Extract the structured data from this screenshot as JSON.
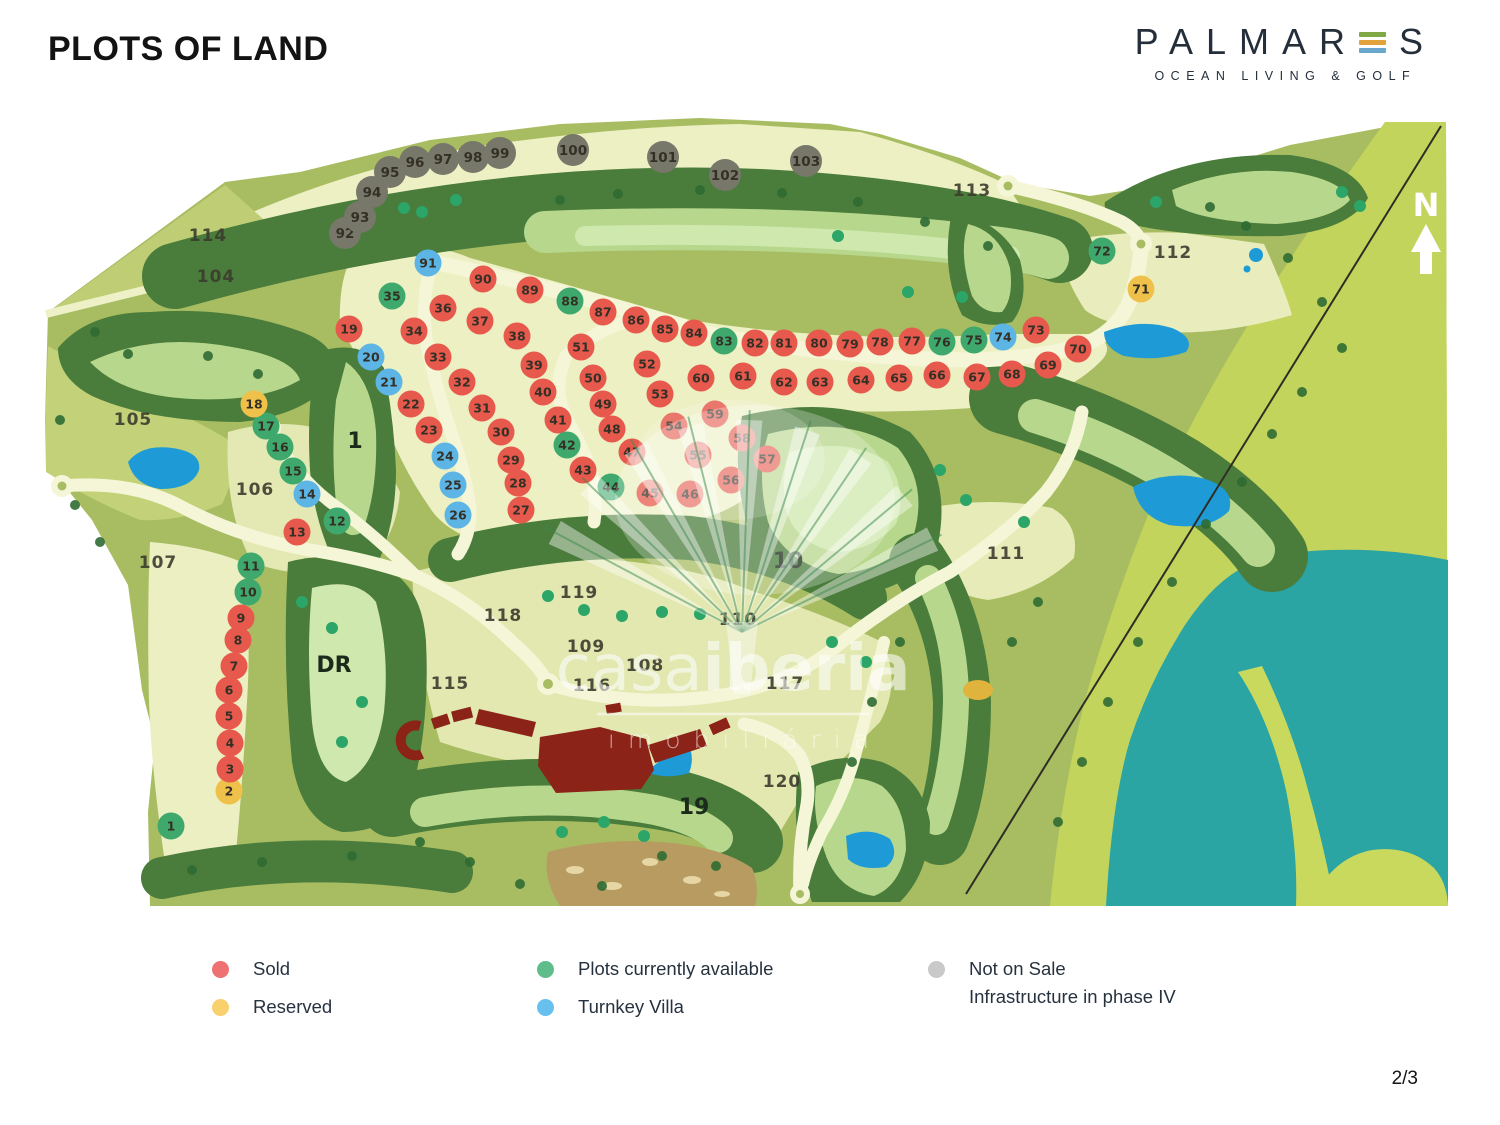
{
  "header": {
    "title": "PLOTS OF LAND"
  },
  "logo": {
    "brand_left": "PALMAR",
    "brand_right": "S",
    "subtitle": "OCEAN LIVING & GOLF",
    "bar_colors": [
      "#7fa944",
      "#e2a33c",
      "#69a7cd"
    ]
  },
  "page": {
    "number": "2/3"
  },
  "compass": {
    "label": "N"
  },
  "watermark": {
    "word1": "casa",
    "word2": "iberia",
    "line2": "imobiliária"
  },
  "legend": {
    "items": [
      {
        "label": "Sold",
        "color": "#ef7272"
      },
      {
        "label": "Reserved",
        "color": "#f8d06d"
      },
      {
        "label": "Plots currently available",
        "color": "#5fbd8b"
      },
      {
        "label": "Turnkey Villa",
        "color": "#67c0ee"
      },
      {
        "label": "Not on Sale",
        "label2": "Infrastructure in phase IV",
        "color": "#c9c9c9"
      }
    ]
  },
  "map": {
    "status_colors": {
      "sold": "#e6594c",
      "reserved": "#f0c14a",
      "available": "#3fa96d",
      "turnkey": "#5cb5e5",
      "notsale": "#77776a"
    },
    "plots": [
      [
        "1",
        171,
        826,
        "available"
      ],
      [
        "2",
        229,
        791,
        "reserved"
      ],
      [
        "3",
        230,
        769,
        "sold"
      ],
      [
        "4",
        230,
        743,
        "sold"
      ],
      [
        "5",
        229,
        716,
        "sold"
      ],
      [
        "6",
        229,
        690,
        "sold"
      ],
      [
        "7",
        234,
        666,
        "sold"
      ],
      [
        "8",
        238,
        640,
        "sold"
      ],
      [
        "9",
        241,
        618,
        "sold"
      ],
      [
        "10",
        248,
        592,
        "available"
      ],
      [
        "11",
        251,
        566,
        "available"
      ],
      [
        "12",
        337,
        521,
        "available"
      ],
      [
        "13",
        297,
        532,
        "sold"
      ],
      [
        "14",
        307,
        494,
        "turnkey"
      ],
      [
        "15",
        293,
        471,
        "available"
      ],
      [
        "16",
        280,
        447,
        "available"
      ],
      [
        "17",
        266,
        426,
        "available"
      ],
      [
        "18",
        254,
        404,
        "reserved"
      ],
      [
        "19",
        349,
        329,
        "sold"
      ],
      [
        "20",
        371,
        357,
        "turnkey"
      ],
      [
        "21",
        389,
        382,
        "turnkey"
      ],
      [
        "22",
        411,
        404,
        "sold"
      ],
      [
        "23",
        429,
        430,
        "sold"
      ],
      [
        "24",
        445,
        456,
        "turnkey"
      ],
      [
        "25",
        453,
        485,
        "turnkey"
      ],
      [
        "26",
        458,
        515,
        "turnkey"
      ],
      [
        "27",
        521,
        510,
        "sold"
      ],
      [
        "28",
        518,
        483,
        "sold"
      ],
      [
        "29",
        511,
        460,
        "sold"
      ],
      [
        "30",
        501,
        432,
        "sold"
      ],
      [
        "31",
        482,
        408,
        "sold"
      ],
      [
        "32",
        462,
        382,
        "sold"
      ],
      [
        "33",
        438,
        357,
        "sold"
      ],
      [
        "34",
        414,
        331,
        "sold"
      ],
      [
        "35",
        392,
        296,
        "available"
      ],
      [
        "36",
        443,
        308,
        "sold"
      ],
      [
        "37",
        480,
        321,
        "sold"
      ],
      [
        "38",
        517,
        336,
        "sold"
      ],
      [
        "39",
        534,
        365,
        "sold"
      ],
      [
        "40",
        543,
        392,
        "sold"
      ],
      [
        "41",
        558,
        420,
        "sold"
      ],
      [
        "42",
        567,
        445,
        "available"
      ],
      [
        "43",
        583,
        470,
        "sold"
      ],
      [
        "44",
        611,
        487,
        "available"
      ],
      [
        "45",
        650,
        493,
        "sold"
      ],
      [
        "46",
        690,
        494,
        "sold"
      ],
      [
        "47",
        632,
        452,
        "sold"
      ],
      [
        "48",
        612,
        429,
        "sold"
      ],
      [
        "49",
        603,
        404,
        "sold"
      ],
      [
        "50",
        593,
        378,
        "sold"
      ],
      [
        "51",
        581,
        347,
        "sold"
      ],
      [
        "52",
        647,
        364,
        "sold"
      ],
      [
        "53",
        660,
        394,
        "sold"
      ],
      [
        "54",
        674,
        426,
        "sold"
      ],
      [
        "55",
        698,
        455,
        "sold"
      ],
      [
        "56",
        731,
        480,
        "sold"
      ],
      [
        "57",
        767,
        459,
        "sold"
      ],
      [
        "58",
        742,
        438,
        "sold"
      ],
      [
        "59",
        715,
        414,
        "sold"
      ],
      [
        "60",
        701,
        378,
        "sold"
      ],
      [
        "61",
        743,
        376,
        "sold"
      ],
      [
        "62",
        784,
        382,
        "sold"
      ],
      [
        "63",
        820,
        382,
        "sold"
      ],
      [
        "64",
        861,
        380,
        "sold"
      ],
      [
        "65",
        899,
        378,
        "sold"
      ],
      [
        "66",
        937,
        375,
        "sold"
      ],
      [
        "67",
        977,
        377,
        "sold"
      ],
      [
        "68",
        1012,
        374,
        "sold"
      ],
      [
        "69",
        1048,
        365,
        "sold"
      ],
      [
        "70",
        1078,
        349,
        "sold"
      ],
      [
        "71",
        1141,
        289,
        "reserved"
      ],
      [
        "72",
        1102,
        251,
        "available"
      ],
      [
        "73",
        1036,
        330,
        "sold"
      ],
      [
        "74",
        1003,
        337,
        "turnkey"
      ],
      [
        "75",
        974,
        340,
        "available"
      ],
      [
        "76",
        942,
        342,
        "available"
      ],
      [
        "77",
        912,
        341,
        "sold"
      ],
      [
        "78",
        880,
        342,
        "sold"
      ],
      [
        "79",
        850,
        344,
        "sold"
      ],
      [
        "80",
        819,
        343,
        "sold"
      ],
      [
        "81",
        784,
        343,
        "sold"
      ],
      [
        "82",
        755,
        343,
        "sold"
      ],
      [
        "83",
        724,
        341,
        "available"
      ],
      [
        "84",
        694,
        333,
        "sold"
      ],
      [
        "85",
        665,
        329,
        "sold"
      ],
      [
        "86",
        636,
        320,
        "sold"
      ],
      [
        "87",
        603,
        312,
        "sold"
      ],
      [
        "88",
        570,
        301,
        "available"
      ],
      [
        "89",
        530,
        290,
        "sold"
      ],
      [
        "90",
        483,
        279,
        "sold"
      ],
      [
        "91",
        428,
        263,
        "turnkey"
      ],
      [
        "92",
        345,
        233,
        "notsale"
      ],
      [
        "93",
        360,
        217,
        "notsale"
      ],
      [
        "94",
        372,
        192,
        "notsale"
      ],
      [
        "95",
        390,
        172,
        "notsale"
      ],
      [
        "96",
        415,
        162,
        "notsale"
      ],
      [
        "97",
        443,
        159,
        "notsale"
      ],
      [
        "98",
        473,
        157,
        "notsale"
      ],
      [
        "99",
        500,
        153,
        "notsale"
      ],
      [
        "100",
        573,
        150,
        "notsale"
      ],
      [
        "101",
        663,
        157,
        "notsale"
      ],
      [
        "102",
        725,
        175,
        "notsale"
      ],
      [
        "103",
        806,
        161,
        "notsale"
      ]
    ],
    "parcels": [
      [
        "104",
        216,
        276
      ],
      [
        "105",
        133,
        419
      ],
      [
        "106",
        255,
        489
      ],
      [
        "107",
        158,
        562
      ],
      [
        "108",
        645,
        665
      ],
      [
        "109",
        586,
        646
      ],
      [
        "110",
        738,
        619
      ],
      [
        "111",
        1006,
        553
      ],
      [
        "112",
        1173,
        252
      ],
      [
        "113",
        972,
        190
      ],
      [
        "114",
        208,
        235
      ],
      [
        "115",
        450,
        683
      ],
      [
        "116",
        592,
        685
      ],
      [
        "117",
        785,
        683
      ],
      [
        "118",
        503,
        615
      ],
      [
        "119",
        579,
        592
      ],
      [
        "120",
        782,
        781
      ]
    ],
    "holes": [
      [
        "1",
        355,
        440
      ],
      [
        "10",
        788,
        560
      ],
      [
        "19",
        694,
        806
      ],
      [
        "DR",
        334,
        664
      ]
    ]
  }
}
